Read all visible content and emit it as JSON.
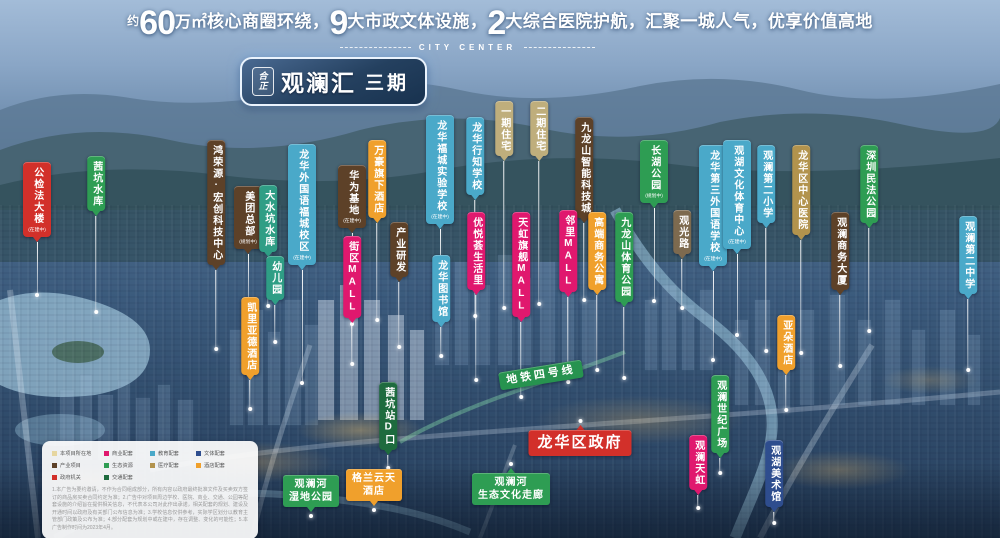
{
  "header": {
    "prefix": "约",
    "big1": "60",
    "unit": "万㎡",
    "seg1": "核心商圈环绕，",
    "big2": "9",
    "seg2": "大市政文体设施，",
    "big3": "2",
    "seg3": "大综合医院护航，汇聚一城人气，优享价值高地",
    "subtitle": "CITY CENTER"
  },
  "badge": {
    "logo_top": "合",
    "logo_bottom": "正",
    "name": "观澜汇",
    "phase": "三期"
  },
  "colors": {
    "red": "#d2302a",
    "green": "#2e9d53",
    "teal": "#2f9e85",
    "dkgreen": "#1e6b3e",
    "metro": "#27934f",
    "edu": "#4aa9c9",
    "navy": "#2e4d8e",
    "pink": "#e0186e",
    "brown": "#5d4128",
    "med": "#b2934d",
    "gold": "#f0a02c",
    "resid": "#bfae7c",
    "roadtag": "#7d6a4f",
    "proj": "#e6d6a0"
  },
  "pins": [
    {
      "t": "公检法大楼",
      "sub": "(在建中)",
      "c": "red",
      "x": 37,
      "y": 162,
      "line": 52
    },
    {
      "t": "茜坑水库",
      "c": "green",
      "x": 96,
      "y": 156,
      "line": 95
    },
    {
      "t": "鸿荣源·宏创科技中心",
      "c": "brown",
      "x": 216,
      "y": 140,
      "line": 78
    },
    {
      "t": "美团总部",
      "sub": "(规划中)",
      "c": "brown",
      "x": 248,
      "y": 186,
      "line": 50
    },
    {
      "t": "大水坑水库",
      "c": "teal",
      "x": 268,
      "y": 185,
      "line": 48
    },
    {
      "t": "龙华外国语福城校区",
      "sub": "(在建中)",
      "c": "edu",
      "x": 302,
      "y": 144,
      "line": 112
    },
    {
      "t": "幼儿园",
      "c": "teal",
      "x": 275,
      "y": 256,
      "line": 36
    },
    {
      "t": "凯里亚德酒店",
      "c": "gold",
      "x": 250,
      "y": 297,
      "line": 28
    },
    {
      "t": "华为基地",
      "sub": "(在建中)",
      "c": "brown",
      "x": 352,
      "y": 165,
      "line": 90
    },
    {
      "t": "街区MALL",
      "c": "pink",
      "x": 352,
      "y": 236,
      "line": 40
    },
    {
      "t": "万豪旗下酒店",
      "c": "gold",
      "x": 377,
      "y": 140,
      "line": 96
    },
    {
      "t": "产业研发",
      "c": "brown",
      "x": 399,
      "y": 222,
      "line": 64
    },
    {
      "t": "龙华福城实验学校",
      "sub": "(在建中)",
      "c": "edu",
      "x": 440,
      "y": 115,
      "line": 70
    },
    {
      "t": "龙华行知学校",
      "c": "edu",
      "x": 475,
      "y": 117,
      "line": 115
    },
    {
      "t": "龙华图书馆",
      "c": "edu",
      "x": 441,
      "y": 255,
      "line": 28
    },
    {
      "t": "优悦荟生活里",
      "c": "pink",
      "x": 476,
      "y": 212,
      "line": 84
    },
    {
      "t": "一期住宅",
      "c": "resid",
      "x": 504,
      "y": 101,
      "line": 146
    },
    {
      "t": "二期住宅",
      "c": "resid",
      "x": 539,
      "y": 101,
      "line": 142
    },
    {
      "t": "天虹旗舰MALL",
      "c": "pink",
      "x": 521,
      "y": 212,
      "line": 74
    },
    {
      "t": "九龙山智能科技城",
      "c": "brown",
      "x": 584,
      "y": 117,
      "line": 76
    },
    {
      "t": "邻里MALL",
      "c": "pink",
      "x": 568,
      "y": 210,
      "line": 84
    },
    {
      "t": "高端商务公寓",
      "c": "gold",
      "x": 597,
      "y": 212,
      "line": 74
    },
    {
      "t": "九龙山体育公园",
      "c": "green",
      "x": 624,
      "y": 212,
      "line": 70
    },
    {
      "t": "长湖公园",
      "sub": "(规划中)",
      "c": "green",
      "x": 654,
      "y": 140,
      "line": 92
    },
    {
      "t": "观光路",
      "c": "roadtag",
      "x": 682,
      "y": 210,
      "line": 48
    },
    {
      "t": "龙华第三外国语学校",
      "sub": "(在建中)",
      "c": "edu",
      "x": 713,
      "y": 145,
      "line": 88
    },
    {
      "t": "观湖文化体育中心",
      "sub": "(在建中)",
      "c": "edu",
      "x": 737,
      "y": 140,
      "line": 80
    },
    {
      "t": "观澜第二小学",
      "c": "edu",
      "x": 766,
      "y": 145,
      "line": 122
    },
    {
      "t": "龙华区中心医院",
      "c": "med",
      "x": 801,
      "y": 145,
      "line": 112
    },
    {
      "t": "观澜商务大厦",
      "c": "brown",
      "x": 840,
      "y": 212,
      "line": 70
    },
    {
      "t": "深圳民法公园",
      "c": "green",
      "x": 869,
      "y": 145,
      "line": 102
    },
    {
      "t": "观澜第二中学",
      "c": "edu",
      "x": 968,
      "y": 216,
      "line": 70
    },
    {
      "t": "亚朵酒店",
      "c": "gold",
      "x": 786,
      "y": 315,
      "line": 34
    },
    {
      "t": "观澜世纪广场",
      "c": "green",
      "x": 720,
      "y": 375,
      "line": 14
    },
    {
      "t": "观澜天虹",
      "c": "pink",
      "x": 698,
      "y": 435,
      "line": 12
    },
    {
      "t": "观湖美术馆",
      "c": "navy",
      "x": 774,
      "y": 440,
      "line": 10
    },
    {
      "t": "茜坑站D口",
      "c": "dkgreen",
      "x": 388,
      "y": 382,
      "line": 12
    }
  ],
  "hlabels": [
    {
      "t": "龙华区政府",
      "c": "red",
      "x": 580,
      "y": 419,
      "cls": "up gov"
    },
    {
      "t": "观澜河\n湿地公园",
      "c": "green",
      "x": 311,
      "y": 475,
      "cls": "down"
    },
    {
      "t": "格兰云天\n酒店",
      "c": "gold",
      "x": 374,
      "y": 469,
      "cls": "down"
    },
    {
      "t": "观澜河\n生态文化走廊",
      "c": "green",
      "x": 511,
      "y": 462,
      "cls": "up"
    },
    {
      "t": "地铁四号线",
      "c": "metro",
      "x": 541,
      "y": 366,
      "rot": -9,
      "cls": "metro"
    }
  ],
  "roads": [
    {
      "t": "观澜大道",
      "x": 14,
      "y": 326,
      "cls": "vert"
    },
    {
      "t": "观澜大道",
      "x": 266,
      "y": 414,
      "cls": "vert"
    },
    {
      "t": "龙华大道",
      "x": 808,
      "y": 466,
      "rot": -36
    }
  ],
  "legend": {
    "items": [
      {
        "label": "本项目所在地",
        "c": "proj"
      },
      {
        "label": "商业配套",
        "c": "pink"
      },
      {
        "label": "教育配套",
        "c": "edu"
      },
      {
        "label": "文体配套",
        "c": "navy"
      },
      {
        "label": "产业项目",
        "c": "brown"
      },
      {
        "label": "生态资源",
        "c": "green"
      },
      {
        "label": "医疗配套",
        "c": "med"
      },
      {
        "label": "酒店配套",
        "c": "gold"
      },
      {
        "label": "政府机关",
        "c": "red"
      },
      {
        "label": "交通配套",
        "c": "dkgreen"
      }
    ],
    "disclaimer": "1.本广告为要约邀请，不作为合同组成部分，所有内容以政府最终批准文件及买卖双方签订的商品房买卖合同约定为准；2.广告中对项目周边学校、医院、商业、交通、公园等配套设施的介绍旨在提供相关信息，不代表本公司对此作出承诺，相关配套的规划、建设及开通时间以政府及有关部门公布信息为准；3.学校信息仅供参考，实际学区划分以教育主管部门政策及公布为准；4.部分配套为规划中或在建中，存在调整、变化的可能性；5.本广告制作时间为2023年4月。"
  }
}
